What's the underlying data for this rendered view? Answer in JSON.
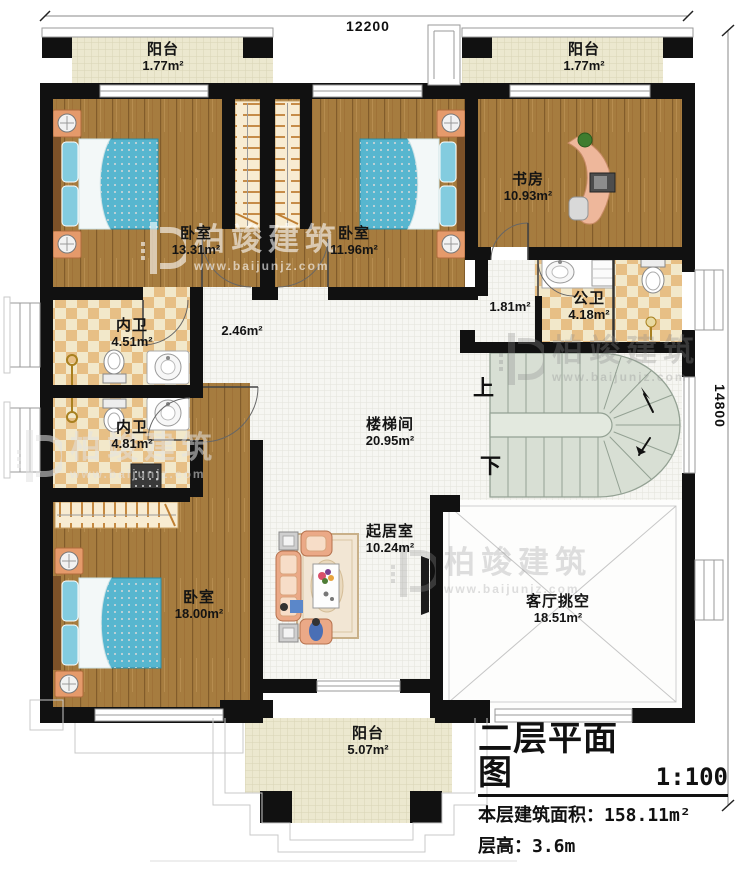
{
  "plan": {
    "floor_title": "二层平面图",
    "scale": "1:100",
    "area_label": "本层建筑面积：",
    "area_value": "158.11m²",
    "height_label": "层高：",
    "height_value": "3.6m"
  },
  "dimensions": {
    "width": "12200",
    "height": "14800"
  },
  "rooms": [
    {
      "id": "balcony-top-left",
      "name": "阳台",
      "area": "1.77m²"
    },
    {
      "id": "balcony-top-right",
      "name": "阳台",
      "area": "1.77m²"
    },
    {
      "id": "bedroom-1",
      "name": "卧室",
      "area": "13.31m²"
    },
    {
      "id": "bedroom-2",
      "name": "卧室",
      "area": "11.96m²"
    },
    {
      "id": "study",
      "name": "书房",
      "area": "10.93m²"
    },
    {
      "id": "public-bath",
      "name": "公卫",
      "area": "4.18m²"
    },
    {
      "id": "hall",
      "name": "",
      "area": "1.81m²"
    },
    {
      "id": "corridor",
      "name": "",
      "area": "2.46m²"
    },
    {
      "id": "inner-bath-1",
      "name": "内卫",
      "area": "4.51m²"
    },
    {
      "id": "inner-bath-2",
      "name": "内卫",
      "area": "4.81m²"
    },
    {
      "id": "stairwell",
      "name": "楼梯间",
      "area": "20.95m²"
    },
    {
      "id": "living",
      "name": "起居室",
      "area": "10.24m²"
    },
    {
      "id": "bedroom-3",
      "name": "卧室",
      "area": "18.00m²"
    },
    {
      "id": "void",
      "name": "客厅挑空",
      "area": "18.51m²"
    },
    {
      "id": "balcony-bottom",
      "name": "阳台",
      "area": "5.07m²"
    }
  ],
  "stairs": {
    "up": "上",
    "down": "下"
  },
  "watermark": {
    "brand": "柏竣建筑",
    "url": "www.baijunjz.com"
  },
  "colors": {
    "wall": "#111111",
    "wood": "#a67c3f",
    "tile": "#f6f6f2",
    "checker": "#e7bf85",
    "balcony": "#ece8cf",
    "stair": "#d8dfd4",
    "bed": "#57b6cf",
    "sofa": "#eba987"
  }
}
